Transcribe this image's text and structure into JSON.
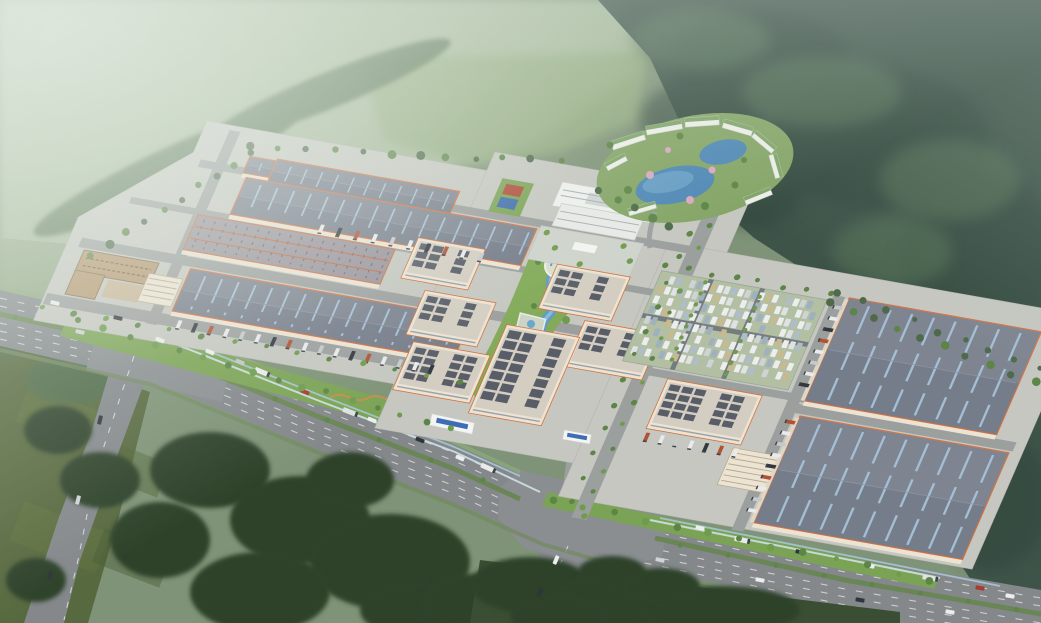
{
  "meta": {
    "type": "aerial-architectural-rendering",
    "subject": "industrial logistics park campus with striped-roof warehouses, headquarters office block, lakeside amenity resort, landscaped river corridor, truck loading docks, employee parking lot, and a multi-lane highway interchange set among hazy green hills",
    "view": "oblique bird's-eye",
    "visible_text": "none"
  },
  "palette": {
    "field_mid": "#7e9377",
    "field_haze": "#a9bc9c",
    "field_light": "#93ab7f",
    "field_light2": "#8ea481",
    "field_dark": "#57693f",
    "forest_dark": "#3e5449",
    "forest_deep": "#33473e",
    "forest_light": "#587659",
    "tree_mid": "#4e6a4a",
    "tree_dark": "#2e4229",
    "tree_green": "#5d8547",
    "tree_bright": "#6f9b4e",
    "tree_autumn": "#d8a45e",
    "road_gray": "#84888b",
    "road_light": "#8a8e91",
    "road_campus": "#9b9f9e",
    "lane_white": "#d9dbdc",
    "median_green": "#6b8656",
    "concrete": "#c5c7c0",
    "lawn": "#7ba355",
    "lawn_bright": "#82aa58",
    "parking_green": "#b2bfa2",
    "water": "#5f9bc4",
    "water_light": "#8cc0de",
    "pond": "#4f88b5",
    "roof_slate": "#767d8a",
    "skylight_blue": "#a9c6dd",
    "roof_mauve": "#99939b",
    "roof_dash": "#5a616c",
    "trim_orange": "#d2703f",
    "ridge_orange": "#c4673a",
    "wall_cream": "#ece3d2",
    "panel_dark": "#4d545f",
    "roof_inset": "#d4cec2",
    "office_white": "#eef0ec",
    "plaza_gray": "#ced3cb",
    "resort_lawn": "#84a566",
    "resort_roof": "#7fa569",
    "resort_white": "#edefe9",
    "blossom_pink": "#d9a8bd",
    "dorm_brown": "#b5976f",
    "dorm_roof": "#8a6f50",
    "court_red": "#b04a37",
    "court_blue": "#3e6cab",
    "truck_white": "#e9eaec",
    "truck_dark": "#32383f",
    "truck_orange": "#b05233",
    "car_white": "#eceeee",
    "car_dark": "#2f353b",
    "car_red": "#a83c2c",
    "fence_light": "#cfe0e8",
    "drain_blue": "#a9c9d8",
    "gate_blue": "#3f6db5",
    "serpentine_wall": "#cc8a4a",
    "haze": "#e7efe7"
  },
  "counts": {
    "left_warehouse_rows": 4,
    "right_large_warehouses": 2,
    "panel_roof_buildings": 7,
    "amenity_ponds": 2,
    "sports_courts": 2,
    "entrance_gates": 2,
    "dormitory_buildings": 1,
    "office_headquarters": 1,
    "parking_lots": 1
  },
  "legend": {
    "campus": "warehouse and factory campus",
    "resort": "amenity hotel area with ponds and green-roof buildings",
    "river": "landscaped serpentine water corridor",
    "highway": "multi-lane arterial with planted median",
    "parking": "grass-paver surface car park",
    "forest": "wooded hills and farmland"
  }
}
